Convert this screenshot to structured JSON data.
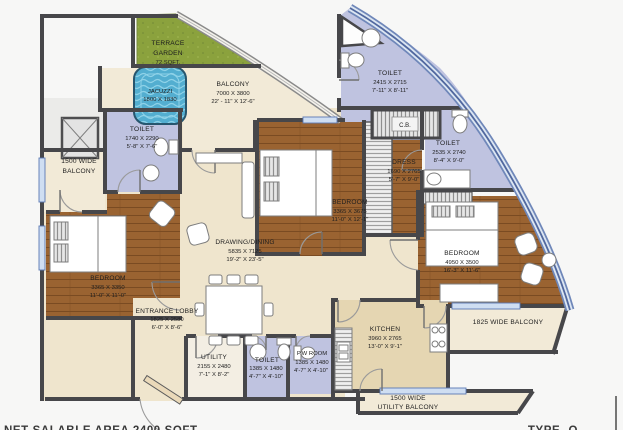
{
  "plan": {
    "notes": {
      "salable_area": "NET SALABLE AREA 2400 SQFT.",
      "type_label": "TYPE- O"
    },
    "colors": {
      "wall": "#47474a",
      "glass": "#51689f",
      "terrace": "#8ba23d",
      "wood": "#9a6331",
      "cream": "#efe5cd",
      "kitchen_tan": "#e5d6b2",
      "lavender": "#bfc3e0",
      "water": "#53aed0"
    },
    "rooms": {
      "terrace_garden": {
        "line1": "TERRACE",
        "line2": "GARDEN",
        "area": "72 SQFT."
      },
      "jacuzzi": {
        "name": "JACUZZI",
        "mm": "1800 X 1830"
      },
      "balcony_top": {
        "name": "BALCONY",
        "mm": "7000 X 3800",
        "ft": "22' - 11\" X 12'-6\""
      },
      "toilet_top": {
        "name": "TOILET",
        "mm": "2415 X 2715",
        "ft": "7'-11\" X 8'-11\""
      },
      "cupboard": {
        "name": "C.B."
      },
      "toilet_left": {
        "name": "TOILET",
        "mm": "1740 X 2290",
        "ft": "5'-8\" X 7'-6\""
      },
      "balcony_left": {
        "line1": "1500 WIDE",
        "line2": "BALCONY"
      },
      "bedroom_left": {
        "name": "BEDROOM",
        "mm": "3365 X 3350",
        "ft": "11'-0\" X 11'-0\""
      },
      "drawing_dining": {
        "name": "DRAWING/DINING",
        "mm": "5835 X 7125",
        "ft": "19'-2\" X 23'-5\""
      },
      "entrance_lobby": {
        "name": "ENTRANCE LOBBY",
        "mm": "1825 X 2580",
        "ft": "6'-0\" X 8'-6\""
      },
      "bedroom_mid": {
        "name": "BEDROOM",
        "mm": "3365 X 3675",
        "ft": "11'-0\" X 12'-1\""
      },
      "dress": {
        "name": "DRESS",
        "mm": "1690 X 2765",
        "ft": "5'-7\" X 9'-0\""
      },
      "toilet_right": {
        "name": "TOILET",
        "mm": "2535 X 2740",
        "ft": "8'-4\" X 9'-0\""
      },
      "bedroom_right": {
        "name": "BEDROOM",
        "mm": "4950 X 3500",
        "ft": "16'-3\" X 11'-6\""
      },
      "balcony_right": {
        "name": "1825 WIDE BALCONY"
      },
      "kitchen": {
        "name": "KITCHEN",
        "mm": "3960 X 2765",
        "ft": "13'-0\" X 9'-1\""
      },
      "utility": {
        "name": "UTILITY",
        "mm": "2155 X 2480",
        "ft": "7'-1\" X 8'-2\""
      },
      "toilet_bottom": {
        "name": "TOILET",
        "mm": "1385 X 1480",
        "ft": "4'-7\" X 4'-10\""
      },
      "pw_room": {
        "name": "P.W ROOM",
        "mm": "1385 X 1480",
        "ft": "4'-7\" X 4'-10\""
      },
      "utility_balcony": {
        "line1": "1500 WIDE",
        "line2": "UTILITY BALCONY"
      }
    }
  }
}
